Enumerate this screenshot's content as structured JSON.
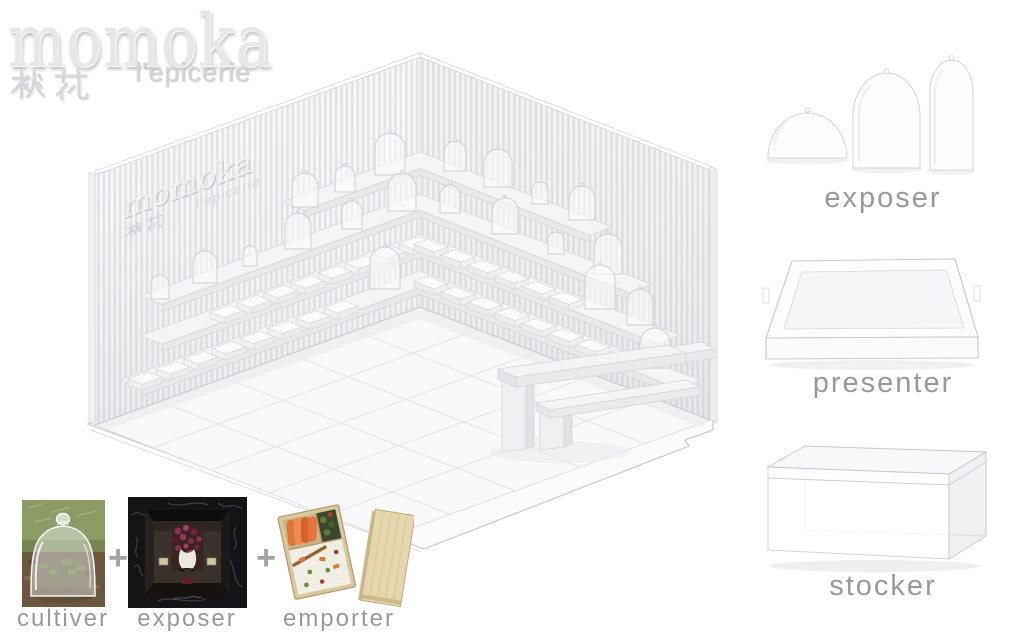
{
  "board": {
    "header": {
      "brand": "momoka",
      "brand_kanji": "桃花",
      "brand_subtitle": "l'epicerie"
    },
    "store": {
      "wall_brand": "momoka",
      "wall_kanji": "桃花",
      "wall_subtitle": "l'epicerie"
    },
    "modules": [
      {
        "id": "exposer",
        "label": "exposer"
      },
      {
        "id": "presenter",
        "label": "presenter"
      },
      {
        "id": "stocker",
        "label": "stocker"
      }
    ],
    "formula": {
      "items": [
        {
          "id": "cultiver",
          "label": "cultiver"
        },
        {
          "id": "exposer",
          "label": "exposer"
        },
        {
          "id": "emporter",
          "label": "emporter"
        }
      ],
      "operator": "+"
    },
    "colors": {
      "label_gray": "#999999",
      "logo_gray": "#e7e7e9",
      "render_line": "#d6d6da",
      "accent_salmon": "#e5743c",
      "accent_purple": "#8a2f56",
      "wood": "#d9c7a0"
    }
  }
}
